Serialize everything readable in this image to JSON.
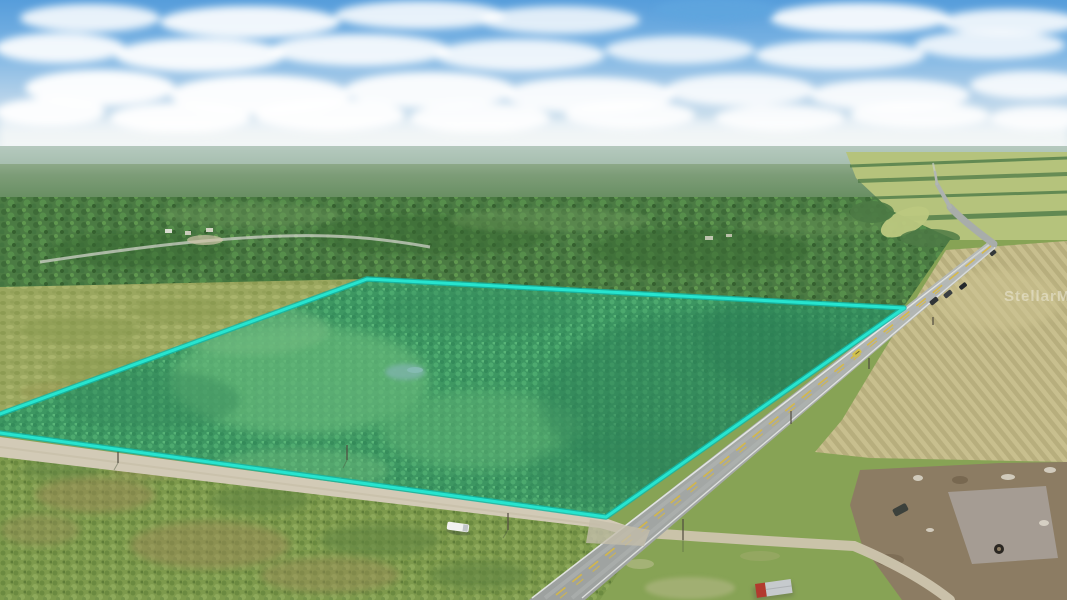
{
  "photo": {
    "kind": "aerial-drone-photo",
    "subject": "Vacant rural land parcel outlined in turquoise beside a two-lane highway"
  },
  "watermark": {
    "text": "StellarMLS",
    "color": "#FFFFFF",
    "opacity": 0.36
  },
  "scene": {
    "sky": {
      "top": "#569DDB",
      "horizon": "#E8F0F2",
      "cloud": "#FFFFFF"
    },
    "land": {
      "distant_forest": "#7D9D78",
      "forest": "#4B7B43",
      "meadow": "#9AA75F",
      "scrub": "#7D9A4C",
      "parcel_vegetation": "#47823F",
      "right_fields": "#B5C37C"
    },
    "parcel": {
      "tint": "rgba(34,214,199,0.26)",
      "outline": "#26E5CF"
    },
    "roads": {
      "highway": "#A6AAA7",
      "center_line": "#D9B93E",
      "edge_line": "#ECEEEC",
      "dirt": "#D2CAB6"
    },
    "fields": {
      "tilled": "#C8BF8E",
      "cleared_dirt": "#8C7C63"
    },
    "vehicles": {
      "white_truck": "#F2F2F0",
      "dark_car": "#32373A",
      "yellow_car": "#D2C14A"
    }
  }
}
